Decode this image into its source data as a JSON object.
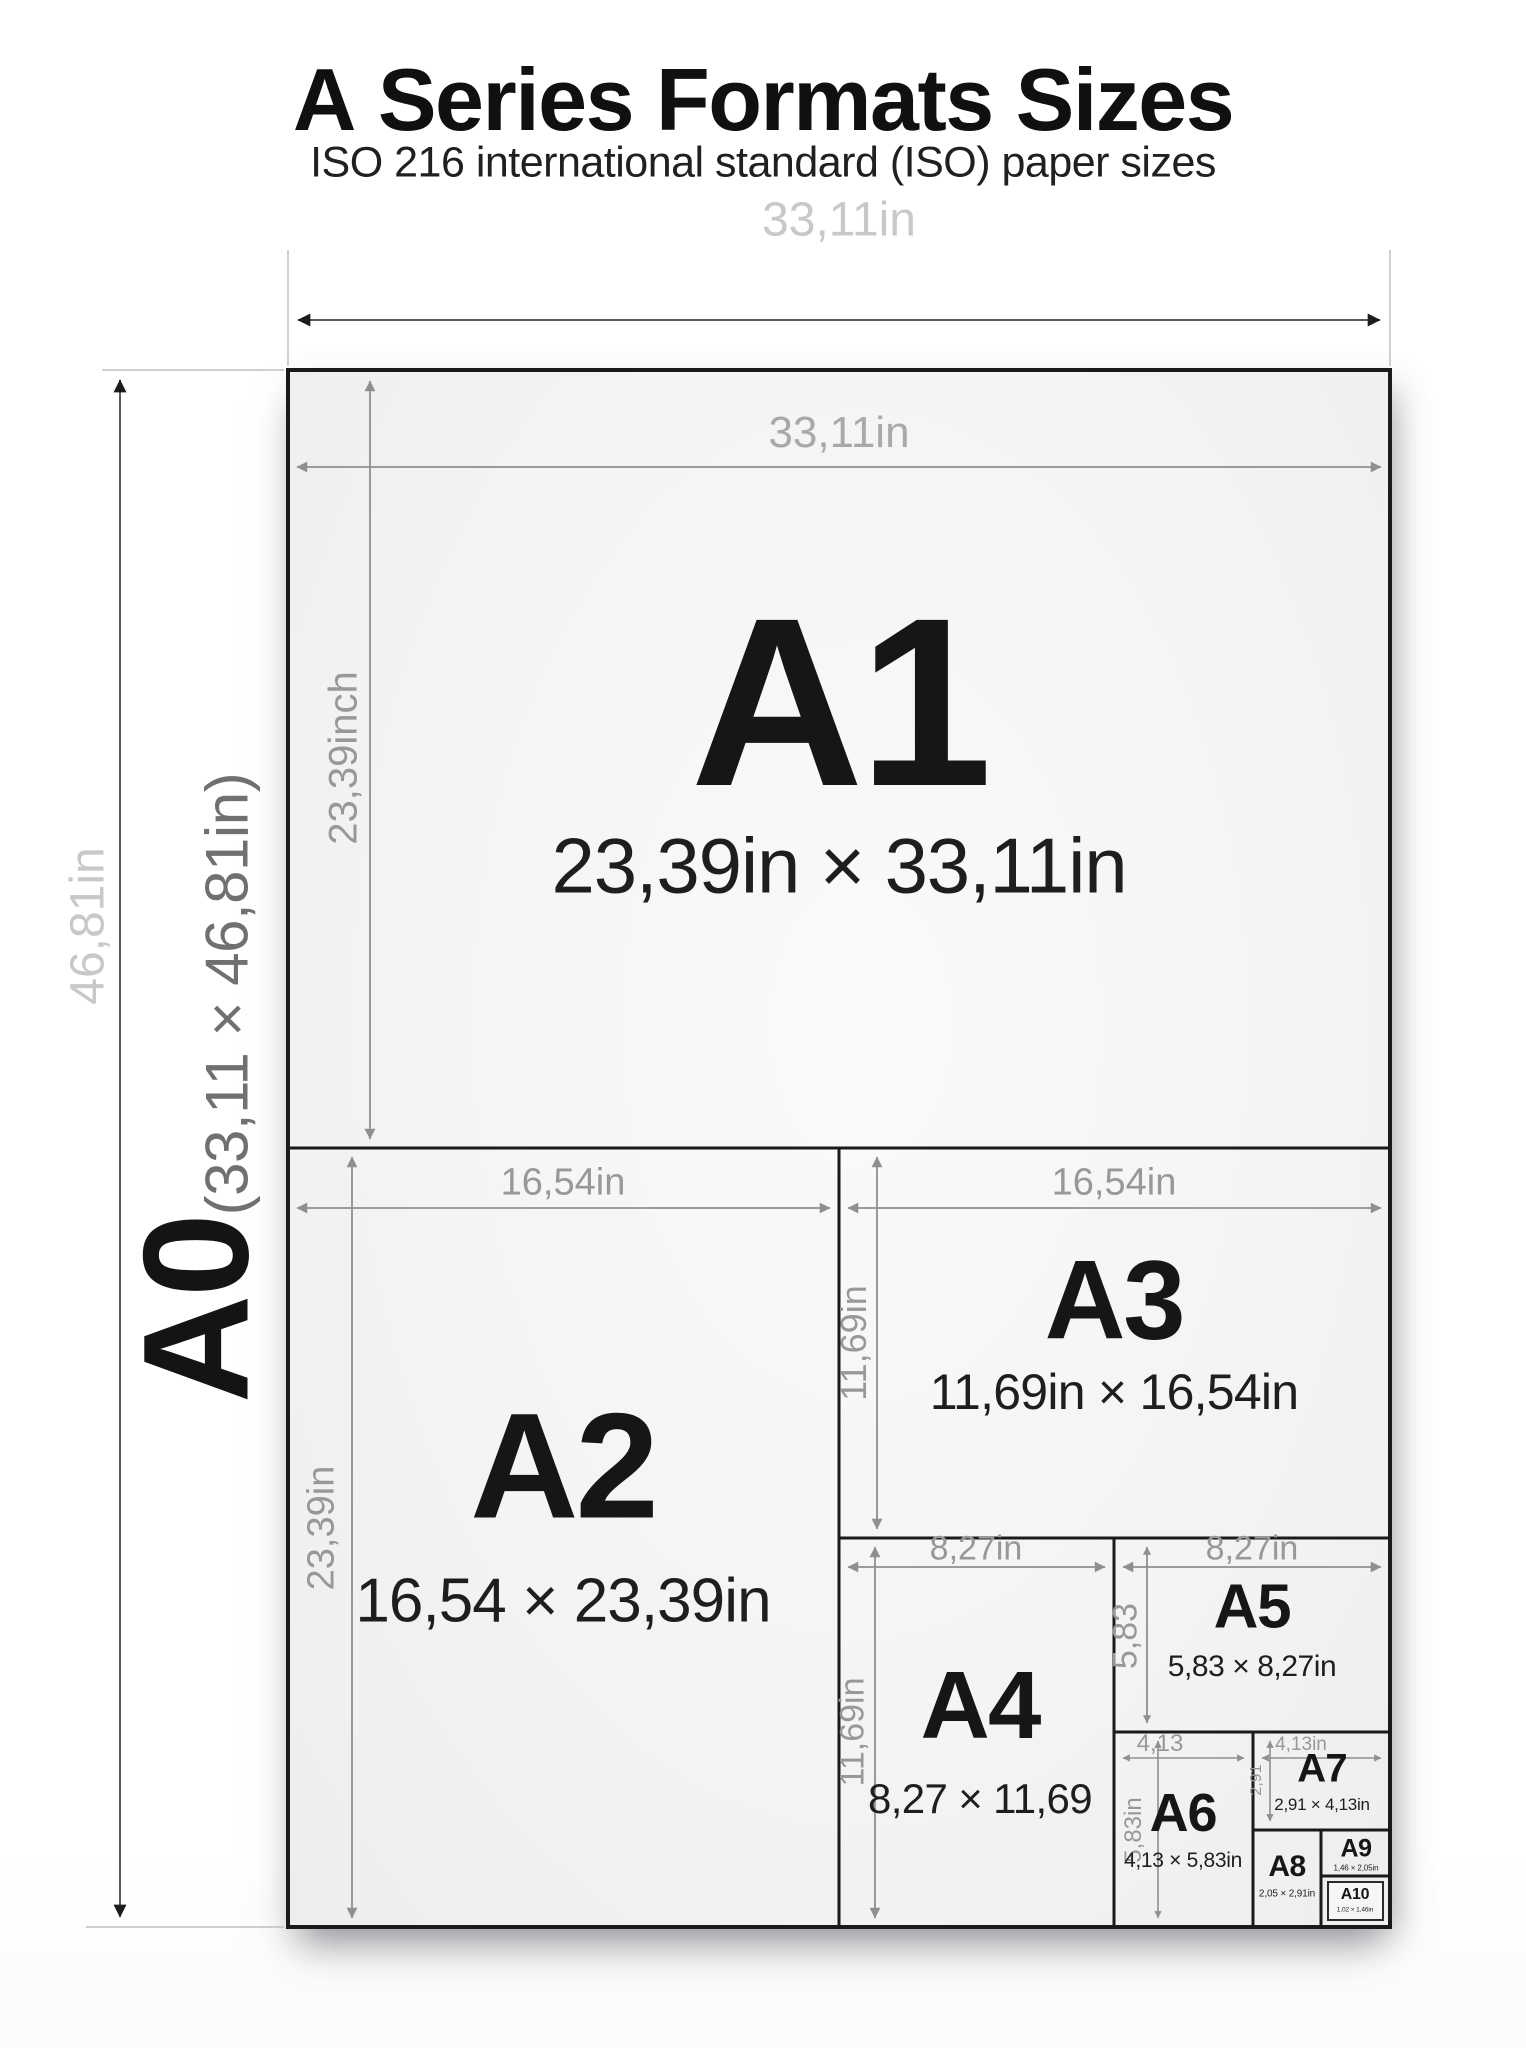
{
  "title": {
    "prefix": "A",
    "rest": " Series Formats Sizes"
  },
  "subtitle": "ISO 216 international standard (ISO) paper sizes",
  "outer": {
    "width_label": "33,11in",
    "height_label": "46,81in"
  },
  "a0": {
    "name": "A0",
    "dims": "(33,11 × 46,81in)"
  },
  "papers": [
    {
      "id": "A1",
      "name": "A1",
      "size": "23,39in × 33,11in",
      "width_label": "33,11in",
      "height_label": "23,39inch"
    },
    {
      "id": "A2",
      "name": "A2",
      "size": "16,54 × 23,39in",
      "width_label": "16,54in",
      "height_label": "23,39in"
    },
    {
      "id": "A3",
      "name": "A3",
      "size": "11,69in × 16,54in",
      "width_label": "16,54in",
      "height_label": "11,69in"
    },
    {
      "id": "A4",
      "name": "A4",
      "size": "8,27 × 11,69",
      "width_label": "8,27in",
      "height_label": "11,69in"
    },
    {
      "id": "A5",
      "name": "A5",
      "size": "5,83 × 8,27in",
      "width_label": "8,27in",
      "height_label": "5,83"
    },
    {
      "id": "A6",
      "name": "A6",
      "size": "4,13 × 5,83in",
      "width_label": "4,13",
      "height_label": "5,83in"
    },
    {
      "id": "A7",
      "name": "A7",
      "size": "2,91 × 4,13in",
      "width_label": "4,13in",
      "height_label": "2,91"
    },
    {
      "id": "A8",
      "name": "A8",
      "size": "2,05 × 2,91in"
    },
    {
      "id": "A9",
      "name": "A9",
      "size": "1,46 × 2,05in"
    },
    {
      "id": "A10",
      "name": "A10",
      "size": "1,02 × 1,46in"
    }
  ],
  "colors": {
    "paper_border": "#1a1a1b",
    "divider": "#1c1c1d",
    "dim_line": "#8e8f90",
    "dim_label": "#97989a",
    "outer_dim_label": "#c7c8c9",
    "text": "#161617",
    "paper_fill": "#f2f2f3"
  }
}
